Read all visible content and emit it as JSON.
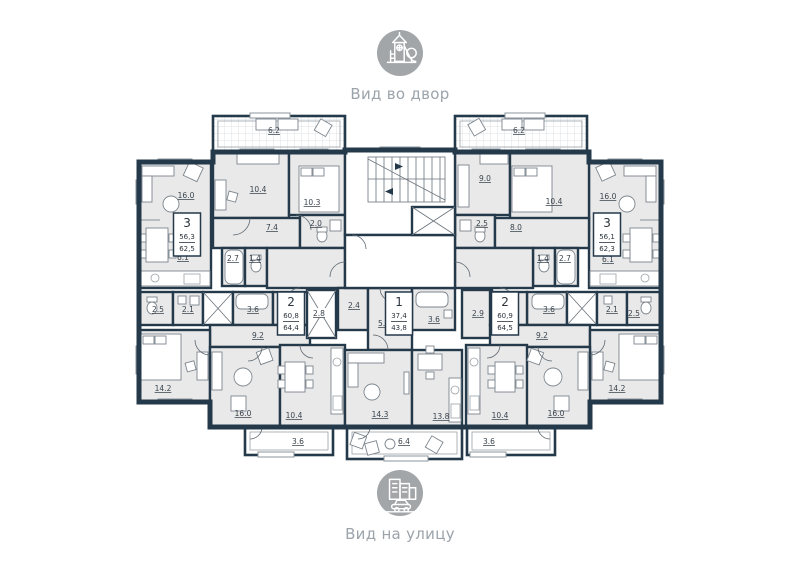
{
  "legends": {
    "top": {
      "icon": "playground-icon",
      "label": "Вид во двор"
    },
    "bottom": {
      "icon": "city-street-icon",
      "label": "Вид на улицу"
    }
  },
  "colors": {
    "wall": "#24394a",
    "room_fill": "#e9e9e9",
    "legend_gray": "#a2a6a9"
  },
  "apartments": [
    {
      "rooms": "3",
      "area_living": "56,3",
      "area_total": "62,5"
    },
    {
      "rooms": "2",
      "area_living": "60,8",
      "area_total": "64,4"
    },
    {
      "rooms": "1",
      "area_living": "37,4",
      "area_total": "43,8"
    },
    {
      "rooms": "2",
      "area_living": "60,9",
      "area_total": "64,5"
    },
    {
      "rooms": "3",
      "area_living": "56,1",
      "area_total": "62,3"
    }
  ],
  "rooms": {
    "apt3l": {
      "balcony": "6.2",
      "living": "16.0",
      "bedroom1": "10.4",
      "bedroom2": "10.3",
      "hall": "7.4",
      "wc": "2.0",
      "kitchen": "6.1",
      "bath": "2.7",
      "toilet": "1.4"
    },
    "apt2l": {
      "wc": "2.5",
      "closet": "2.1",
      "bath": "3.6",
      "hall": "9.2",
      "bedroom": "14.2",
      "living": "16.0",
      "kitchen": "10.4",
      "balcony": "3.6"
    },
    "apt1": {
      "shaft": "2.8",
      "corridor": "2.4",
      "hall": "5.7",
      "bath": "3.6",
      "living": "14.3",
      "kitchen": "13.8",
      "balcony": "6.4"
    },
    "apt2r": {
      "closet": "2.9",
      "hall": "9.2",
      "bath": "3.6",
      "wc": "2.1",
      "storage": "2.5",
      "bedroom": "14.2",
      "living": "16.0",
      "kitchen": "10.4",
      "balcony": "3.6"
    },
    "apt3r": {
      "balcony": "6.2",
      "bedroom1": "9.0",
      "bedroom2": "10.4",
      "wc": "2.5",
      "hall": "8.0",
      "toilet": "1.4",
      "bath": "2.7",
      "living": "16.0",
      "kitchen": "6.1"
    }
  }
}
